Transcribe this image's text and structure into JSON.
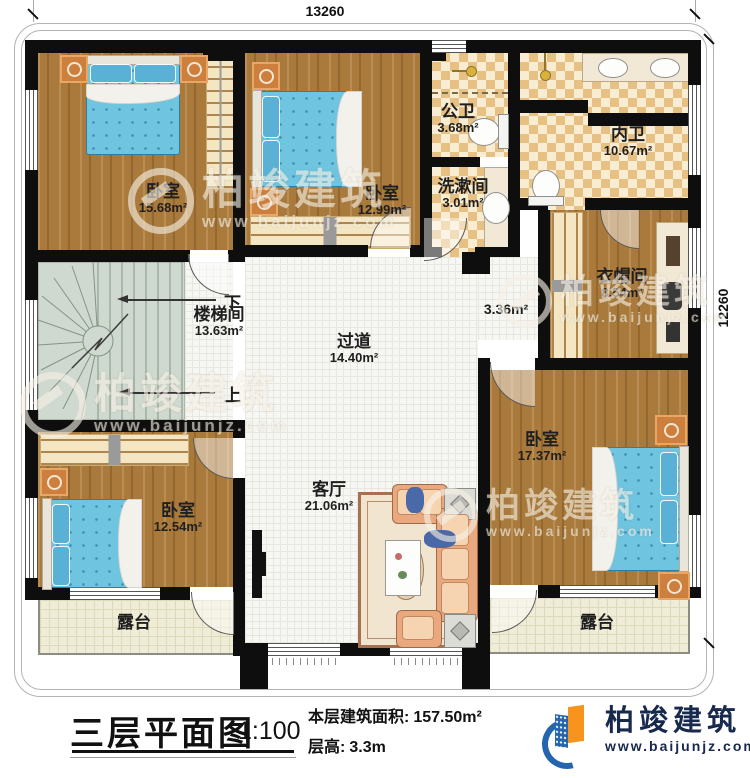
{
  "dimensions": {
    "width_mm": "13260",
    "height_mm": "12260"
  },
  "rooms": {
    "bedroom_top_left": {
      "name": "卧室",
      "area": "15.68m²"
    },
    "bedroom_top_mid": {
      "name": "卧室",
      "area": "12.99m²"
    },
    "public_bathroom": {
      "name": "公卫",
      "area": "3.68m²"
    },
    "washroom": {
      "name": "洗漱间",
      "area": "3.01m²"
    },
    "master_bathroom": {
      "name": "内卫",
      "area": "10.67m²"
    },
    "cloakroom": {
      "name": "衣帽间",
      "area": "8.54m²"
    },
    "stairwell": {
      "name": "楼梯间",
      "area": "13.63m²"
    },
    "hallway": {
      "name": "过道",
      "area": "14.40m²"
    },
    "hallway_nook": {
      "area": "3.36m²"
    },
    "bedroom_bottom_left": {
      "name": "卧室",
      "area": "12.54m²"
    },
    "bedroom_bottom_right": {
      "name": "卧室",
      "area": "17.37m²"
    },
    "living_room": {
      "name": "客厅",
      "area": "21.06m²"
    },
    "terrace_left": {
      "name": "露台"
    },
    "terrace_right": {
      "name": "露台"
    }
  },
  "stairs": {
    "down_label": "下",
    "up_label": "上"
  },
  "title_block": {
    "title": "三层平面图",
    "scale": "1:100",
    "floor_area_label": "本层建筑面积:",
    "floor_area_value": "157.50m²",
    "floor_height_label": "层高:",
    "floor_height_value": "3.3m"
  },
  "brand": {
    "name": "柏竣建筑",
    "website": "www.baijunjz.com"
  },
  "watermark": {
    "name": "柏竣建筑",
    "website": "www.baijunjz.com"
  },
  "colors": {
    "logo_blue": "#2465ad",
    "logo_orange": "#f7941e",
    "wall": "#0e0e0e",
    "bed_blue": "#6fc4e0",
    "wood": "#a97a3c"
  }
}
